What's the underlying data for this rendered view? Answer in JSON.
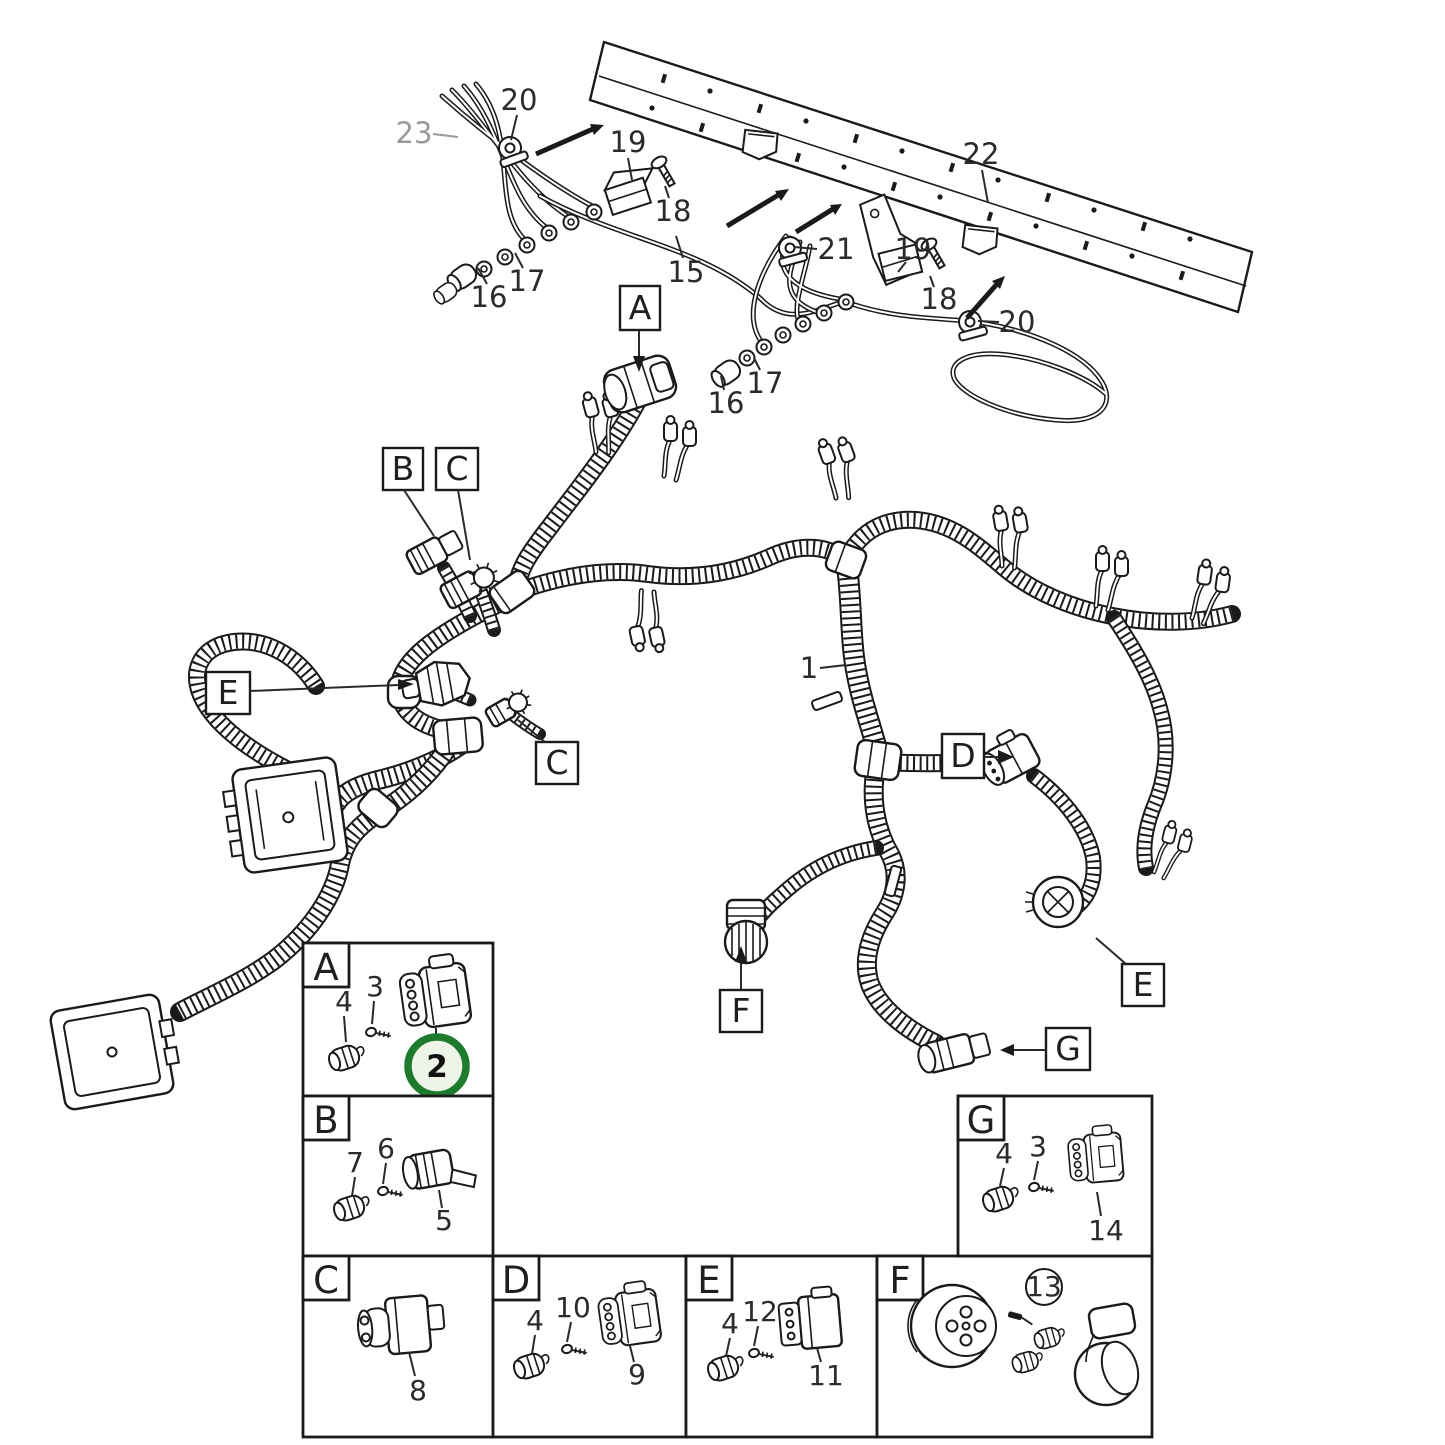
{
  "figure": {
    "type": "exploded-parts-diagram",
    "subject": "engine cable harness with frame rail and connector detail panels",
    "colors": {
      "line": "#1a1a1a",
      "background": "#ffffff",
      "muted_label": "#9a9a9a"
    },
    "highlight": {
      "selected_part": "2",
      "ring_color": "#1e7b2d",
      "fill_color": "#edf3e7"
    }
  },
  "callouts": {
    "a_top": "A",
    "b": "B",
    "c_top": "C",
    "c_mid": "C",
    "e_left": "E",
    "d": "D",
    "e_right": "E",
    "f": "F",
    "g": "G",
    "item_1": "1"
  },
  "top_assembly": {
    "n15": "15",
    "n16_left": "16",
    "n16_right": "16",
    "n17_left": "17",
    "n17_right": "17",
    "n18_left": "18",
    "n18_right": "18",
    "n19_left": "19",
    "n19_right": "19",
    "n20_left": "20",
    "n20_right": "20",
    "n21": "21",
    "n22": "22",
    "n23": "23"
  },
  "panels": {
    "a": {
      "letter": "A",
      "n2": "2",
      "n3": "3",
      "n4": "4"
    },
    "b": {
      "letter": "B",
      "n5": "5",
      "n6": "6",
      "n7": "7"
    },
    "c": {
      "letter": "C",
      "n8": "8"
    },
    "d": {
      "letter": "D",
      "n4": "4",
      "n9": "9",
      "n10": "10"
    },
    "e": {
      "letter": "E",
      "n4": "4",
      "n11": "11",
      "n12": "12"
    },
    "f": {
      "letter": "F",
      "n13": "13"
    },
    "g": {
      "letter": "G",
      "n3": "3",
      "n4": "4",
      "n14": "14"
    }
  }
}
